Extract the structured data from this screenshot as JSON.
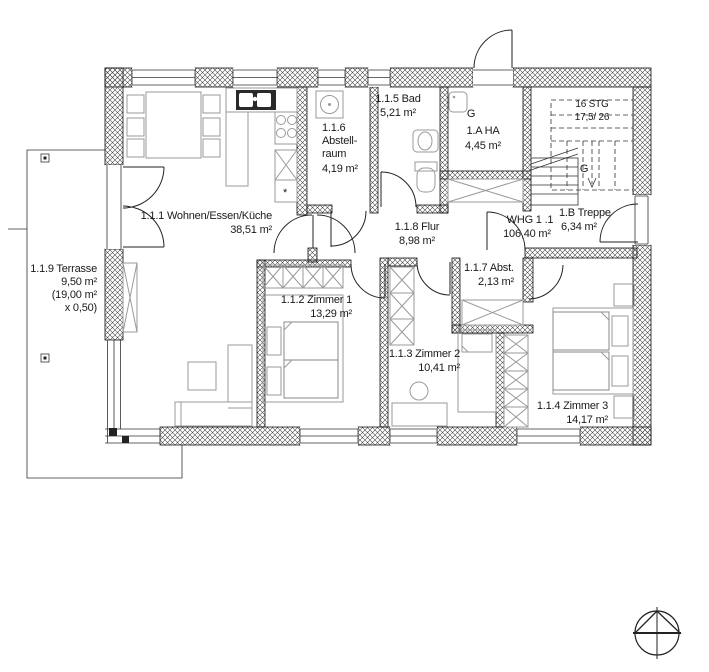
{
  "drawing": {
    "kind": "apartment-floor-plan",
    "unit_label": "WHG 1 .1",
    "unit_area": "106,40 m²"
  },
  "rooms": {
    "wohnen": {
      "label": "1.1.1 Wohnen/Essen/Küche",
      "area": "38,51 m²"
    },
    "zimmer1": {
      "label": "1.1.2 Zimmer 1",
      "area": "13,29 m²"
    },
    "zimmer2": {
      "label": "1.1.3 Zimmer 2",
      "area": "10,41 m²"
    },
    "zimmer3": {
      "label": "1.1.4 Zimmer 3",
      "area": "14,17 m²"
    },
    "bad": {
      "label": "1.1.5 Bad",
      "area": "5,21 m²"
    },
    "abstellraum": {
      "num": "1.1.6",
      "name1": "Abstell-",
      "name2": "raum",
      "area": "4,19 m²"
    },
    "abstellkammer": {
      "label": "1.1.7 Abst.",
      "area": "2,13 m²"
    },
    "flur": {
      "label": "1.1.8 Flur",
      "area": "8,98 m²"
    },
    "terrasse": {
      "label": "1.1.9 Terrasse",
      "area": "9,50 m²",
      "gross": "(19,00 m²",
      "factor": "x 0,50)"
    },
    "hausanschluss": {
      "tag": "G",
      "label": "1.A HA",
      "area": "4,45 m²"
    },
    "treppe": {
      "label": "1.B Treppe",
      "area": "6,34 m²"
    }
  },
  "stairs": {
    "steps": "16 STG",
    "dims": "17,5/ 26",
    "tag": "G"
  },
  "colors": {
    "wall": "#1a1a1a",
    "furniture": "#9a9a9a",
    "text": "#1a1a1a"
  }
}
